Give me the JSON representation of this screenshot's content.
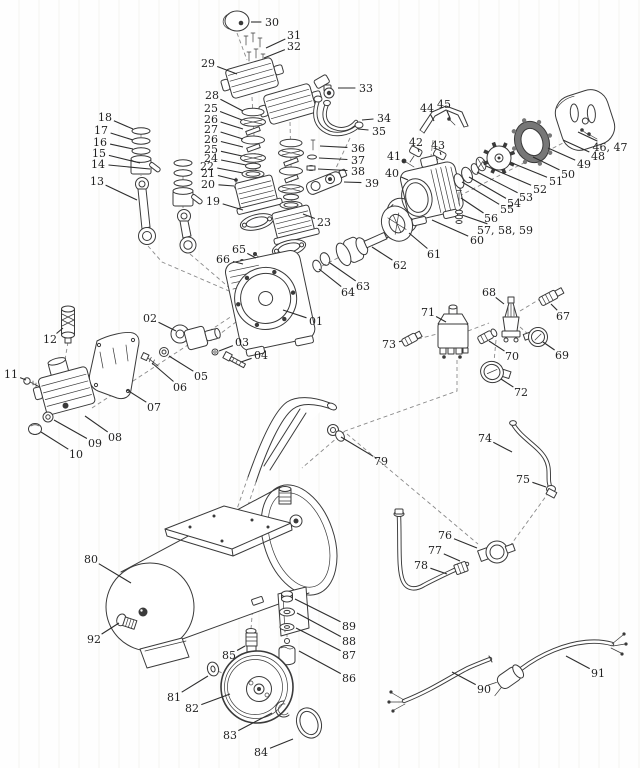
{
  "canvas": {
    "width": 640,
    "height": 768
  },
  "colors": {
    "background": "#fdfdfc",
    "ink": "#3a3a3a",
    "label": "#222222",
    "dash": "#8a8a8a"
  },
  "diagram": {
    "type": "exploded-parts-diagram",
    "callout_font_px": 11,
    "callouts": [
      {
        "label": "30",
        "x": 272,
        "y": 22,
        "px": 251,
        "py": 22
      },
      {
        "label": "31",
        "x": 294,
        "y": 35,
        "px": 266,
        "py": 48
      },
      {
        "label": "32",
        "x": 294,
        "y": 46,
        "px": 264,
        "py": 58
      },
      {
        "label": "29",
        "x": 208,
        "y": 63,
        "px": 237,
        "py": 74
      },
      {
        "label": "33",
        "x": 366,
        "y": 88,
        "px": 338,
        "py": 88
      },
      {
        "label": "34",
        "x": 384,
        "y": 118,
        "px": 362,
        "py": 120
      },
      {
        "label": "35",
        "x": 379,
        "y": 131,
        "px": 358,
        "py": 129
      },
      {
        "label": "18",
        "x": 105,
        "y": 117,
        "px": 133,
        "py": 129
      },
      {
        "label": "17",
        "x": 101,
        "y": 130,
        "px": 133,
        "py": 140
      },
      {
        "label": "16",
        "x": 100,
        "y": 142,
        "px": 133,
        "py": 149
      },
      {
        "label": "15",
        "x": 99,
        "y": 153,
        "px": 140,
        "py": 163
      },
      {
        "label": "14",
        "x": 98,
        "y": 164,
        "px": 150,
        "py": 169
      },
      {
        "label": "13",
        "x": 97,
        "y": 181,
        "px": 137,
        "py": 200
      },
      {
        "label": "28",
        "x": 212,
        "y": 95,
        "px": 243,
        "py": 111
      },
      {
        "label": "25",
        "x": 211,
        "y": 108,
        "px": 242,
        "py": 120
      },
      {
        "label": "26",
        "x": 211,
        "y": 119,
        "px": 243,
        "py": 129
      },
      {
        "label": "27",
        "x": 211,
        "y": 129,
        "px": 243,
        "py": 139
      },
      {
        "label": "26",
        "x": 211,
        "y": 139,
        "px": 243,
        "py": 147
      },
      {
        "label": "25",
        "x": 211,
        "y": 149,
        "px": 242,
        "py": 156
      },
      {
        "label": "24",
        "x": 211,
        "y": 158,
        "px": 246,
        "py": 165
      },
      {
        "label": "22",
        "x": 207,
        "y": 166,
        "px": 243,
        "py": 173
      },
      {
        "label": "21",
        "x": 208,
        "y": 173,
        "px": 236,
        "py": 180
      },
      {
        "label": "20",
        "x": 208,
        "y": 184,
        "px": 234,
        "py": 186
      },
      {
        "label": "19",
        "x": 213,
        "y": 201,
        "px": 243,
        "py": 210
      },
      {
        "label": "23",
        "x": 324,
        "y": 222,
        "px": 303,
        "py": 214
      },
      {
        "label": "36",
        "x": 358,
        "y": 148,
        "px": 320,
        "py": 146
      },
      {
        "label": "37",
        "x": 358,
        "y": 160,
        "px": 319,
        "py": 158
      },
      {
        "label": "38",
        "x": 358,
        "y": 171,
        "px": 318,
        "py": 169
      },
      {
        "label": "39",
        "x": 372,
        "y": 183,
        "px": 344,
        "py": 182
      },
      {
        "label": "44",
        "x": 427,
        "y": 108,
        "px": 434,
        "py": 121
      },
      {
        "label": "45",
        "x": 444,
        "y": 104,
        "px": 450,
        "py": 118
      },
      {
        "label": "42",
        "x": 416,
        "y": 142,
        "px": 419,
        "py": 152
      },
      {
        "label": "43",
        "x": 438,
        "y": 145,
        "px": 441,
        "py": 155
      },
      {
        "label": "41",
        "x": 394,
        "y": 156,
        "px": 404,
        "py": 162
      },
      {
        "label": "40",
        "x": 392,
        "y": 173,
        "px": 408,
        "py": 180
      },
      {
        "label": "46, 47",
        "x": 610,
        "y": 147,
        "px": 578,
        "py": 132
      },
      {
        "label": "48",
        "x": 598,
        "y": 156,
        "px": 563,
        "py": 140
      },
      {
        "label": "49",
        "x": 584,
        "y": 164,
        "px": 548,
        "py": 148
      },
      {
        "label": "50",
        "x": 568,
        "y": 174,
        "px": 533,
        "py": 157
      },
      {
        "label": "51",
        "x": 556,
        "y": 181,
        "px": 512,
        "py": 163
      },
      {
        "label": "52",
        "x": 540,
        "y": 189,
        "px": 486,
        "py": 166
      },
      {
        "label": "53",
        "x": 526,
        "y": 197,
        "px": 477,
        "py": 172
      },
      {
        "label": "54",
        "x": 514,
        "y": 203,
        "px": 469,
        "py": 177
      },
      {
        "label": "55",
        "x": 507,
        "y": 209,
        "px": 462,
        "py": 182
      },
      {
        "label": "56",
        "x": 491,
        "y": 218,
        "px": 461,
        "py": 198
      },
      {
        "label": "57, 58, 59",
        "x": 505,
        "y": 230,
        "px": 462,
        "py": 215
      },
      {
        "label": "60",
        "x": 477,
        "y": 240,
        "px": 432,
        "py": 220
      },
      {
        "label": "61",
        "x": 434,
        "y": 254,
        "px": 409,
        "py": 233
      },
      {
        "label": "62",
        "x": 400,
        "y": 265,
        "px": 372,
        "py": 247
      },
      {
        "label": "63",
        "x": 363,
        "y": 286,
        "px": 330,
        "py": 263
      },
      {
        "label": "64",
        "x": 348,
        "y": 292,
        "px": 319,
        "py": 269
      },
      {
        "label": "65",
        "x": 239,
        "y": 249,
        "px": 256,
        "py": 258
      },
      {
        "label": "66",
        "x": 223,
        "y": 259,
        "px": 243,
        "py": 264
      },
      {
        "label": "01",
        "x": 316,
        "y": 321,
        "px": 283,
        "py": 310
      },
      {
        "label": "02",
        "x": 150,
        "y": 318,
        "px": 176,
        "py": 331
      },
      {
        "label": "03",
        "x": 242,
        "y": 342,
        "px": 219,
        "py": 351
      },
      {
        "label": "04",
        "x": 261,
        "y": 355,
        "px": 241,
        "py": 362
      },
      {
        "label": "05",
        "x": 201,
        "y": 376,
        "px": 169,
        "py": 356
      },
      {
        "label": "06",
        "x": 180,
        "y": 387,
        "px": 152,
        "py": 363
      },
      {
        "label": "07",
        "x": 154,
        "y": 407,
        "px": 127,
        "py": 390
      },
      {
        "label": "12",
        "x": 50,
        "y": 339,
        "px": 63,
        "py": 328
      },
      {
        "label": "11",
        "x": 11,
        "y": 374,
        "px": 26,
        "py": 380
      },
      {
        "label": "08",
        "x": 115,
        "y": 437,
        "px": 85,
        "py": 416
      },
      {
        "label": "09",
        "x": 95,
        "y": 443,
        "px": 54,
        "py": 420
      },
      {
        "label": "10",
        "x": 76,
        "y": 454,
        "px": 41,
        "py": 432
      },
      {
        "label": "68",
        "x": 489,
        "y": 292,
        "px": 504,
        "py": 304
      },
      {
        "label": "67",
        "x": 563,
        "y": 316,
        "px": 551,
        "py": 304
      },
      {
        "label": "71",
        "x": 428,
        "y": 312,
        "px": 446,
        "py": 322
      },
      {
        "label": "73",
        "x": 389,
        "y": 344,
        "px": 402,
        "py": 341
      },
      {
        "label": "70",
        "x": 512,
        "y": 356,
        "px": 489,
        "py": 341
      },
      {
        "label": "69",
        "x": 562,
        "y": 355,
        "px": 543,
        "py": 342
      },
      {
        "label": "72",
        "x": 521,
        "y": 392,
        "px": 501,
        "py": 379
      },
      {
        "label": "79",
        "x": 381,
        "y": 461,
        "px": 341,
        "py": 437
      },
      {
        "label": "74",
        "x": 485,
        "y": 438,
        "px": 512,
        "py": 452
      },
      {
        "label": "75",
        "x": 523,
        "y": 479,
        "px": 546,
        "py": 487
      },
      {
        "label": "76",
        "x": 445,
        "y": 535,
        "px": 477,
        "py": 548
      },
      {
        "label": "77",
        "x": 435,
        "y": 550,
        "px": 460,
        "py": 561
      },
      {
        "label": "78",
        "x": 421,
        "y": 565,
        "px": 447,
        "py": 574
      },
      {
        "label": "80",
        "x": 91,
        "y": 559,
        "px": 131,
        "py": 583
      },
      {
        "label": "92",
        "x": 94,
        "y": 639,
        "px": 119,
        "py": 623
      },
      {
        "label": "85",
        "x": 229,
        "y": 655,
        "px": 245,
        "py": 646
      },
      {
        "label": "81",
        "x": 174,
        "y": 697,
        "px": 208,
        "py": 676
      },
      {
        "label": "82",
        "x": 192,
        "y": 708,
        "px": 230,
        "py": 694
      },
      {
        "label": "83",
        "x": 230,
        "y": 735,
        "px": 272,
        "py": 713
      },
      {
        "label": "84",
        "x": 261,
        "y": 752,
        "px": 293,
        "py": 739
      },
      {
        "label": "89",
        "x": 349,
        "y": 626,
        "px": 295,
        "py": 599
      },
      {
        "label": "88",
        "x": 349,
        "y": 641,
        "px": 297,
        "py": 613
      },
      {
        "label": "87",
        "x": 349,
        "y": 655,
        "px": 296,
        "py": 628
      },
      {
        "label": "86",
        "x": 349,
        "y": 678,
        "px": 299,
        "py": 651
      },
      {
        "label": "90",
        "x": 484,
        "y": 689,
        "px": 452,
        "py": 672
      },
      {
        "label": "91",
        "x": 598,
        "y": 673,
        "px": 566,
        "py": 656
      }
    ]
  }
}
